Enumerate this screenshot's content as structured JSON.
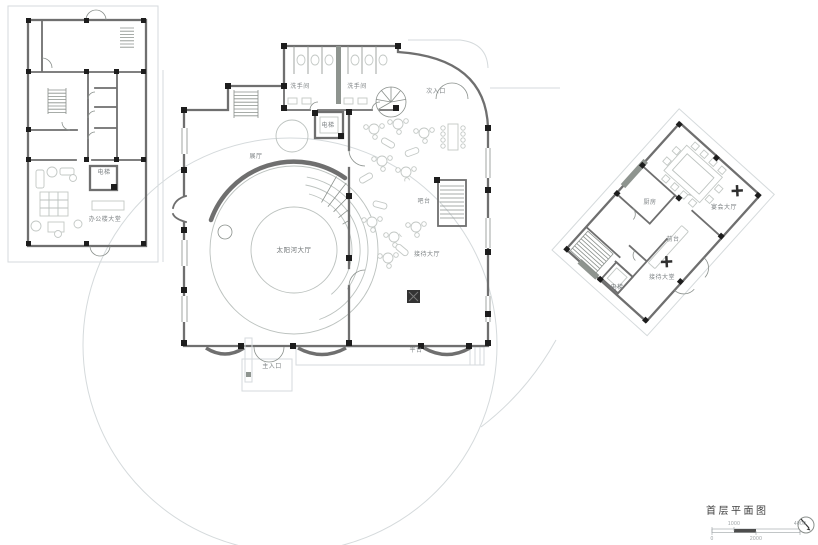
{
  "drawing": {
    "title": "首层平面图",
    "scale_bar": {
      "n0": "0",
      "n1000": "1000",
      "n2000": "2000",
      "n4000": "4000"
    },
    "icons": {
      "north_arrow": "compass-needle"
    }
  },
  "office_building": {
    "elevator": "电梯",
    "lobby": "办公楼大堂"
  },
  "main_building": {
    "washroom_left": "洗手间",
    "washroom_right": "洗手间",
    "secondary_entrance": "次入口",
    "elevator": "电梯",
    "exhibition_hall": "展厅",
    "bar_counter": "吧台",
    "sun_river_hall": "太阳河大厅",
    "reception_hall": "接待大厅",
    "platform": "平台",
    "main_entrance": "主入口"
  },
  "annex_building": {
    "kitchen": "厨房",
    "banquet_hall": "宴会大厅",
    "front_desk": "前台",
    "reception_lobby": "接待大堂",
    "elevator": "电梯"
  },
  "colors": {
    "floor_fill": "#e7eae8",
    "wall": "#6f6f6f",
    "column": "#1d1d1d",
    "site_line": "#d5dadc",
    "label_text": "#7d8284"
  }
}
